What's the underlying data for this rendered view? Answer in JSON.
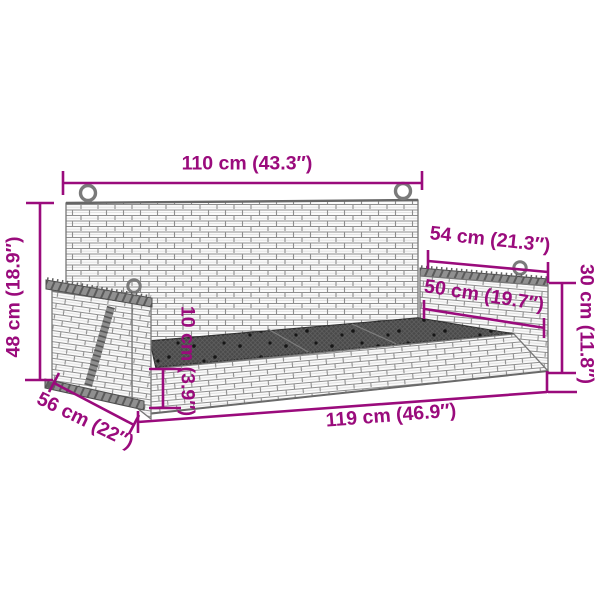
{
  "page": {
    "type": "product dimension diagram",
    "subject": "poly rattan hanging swing bench line drawing",
    "background": "#ffffff"
  },
  "colors": {
    "dimension_accent": "#9A0B7C",
    "drawing_outline": "#7a7a7a",
    "wood_rail": "#909090",
    "seat_mesh": "#4a4a4a"
  },
  "dimensions": {
    "back_width": "110 cm (43.3″)",
    "back_height": "48 cm (18.9″)",
    "armrest_top_length": "54 cm (21.3″)",
    "armrest_panel_length": "50 cm (19.7″)",
    "side_height": "30 cm (11.8″)",
    "seat_thickness": "10 cm (3.9″)",
    "overall_width": "119 cm (46.9″)",
    "seat_depth": "56 cm (22″)"
  }
}
